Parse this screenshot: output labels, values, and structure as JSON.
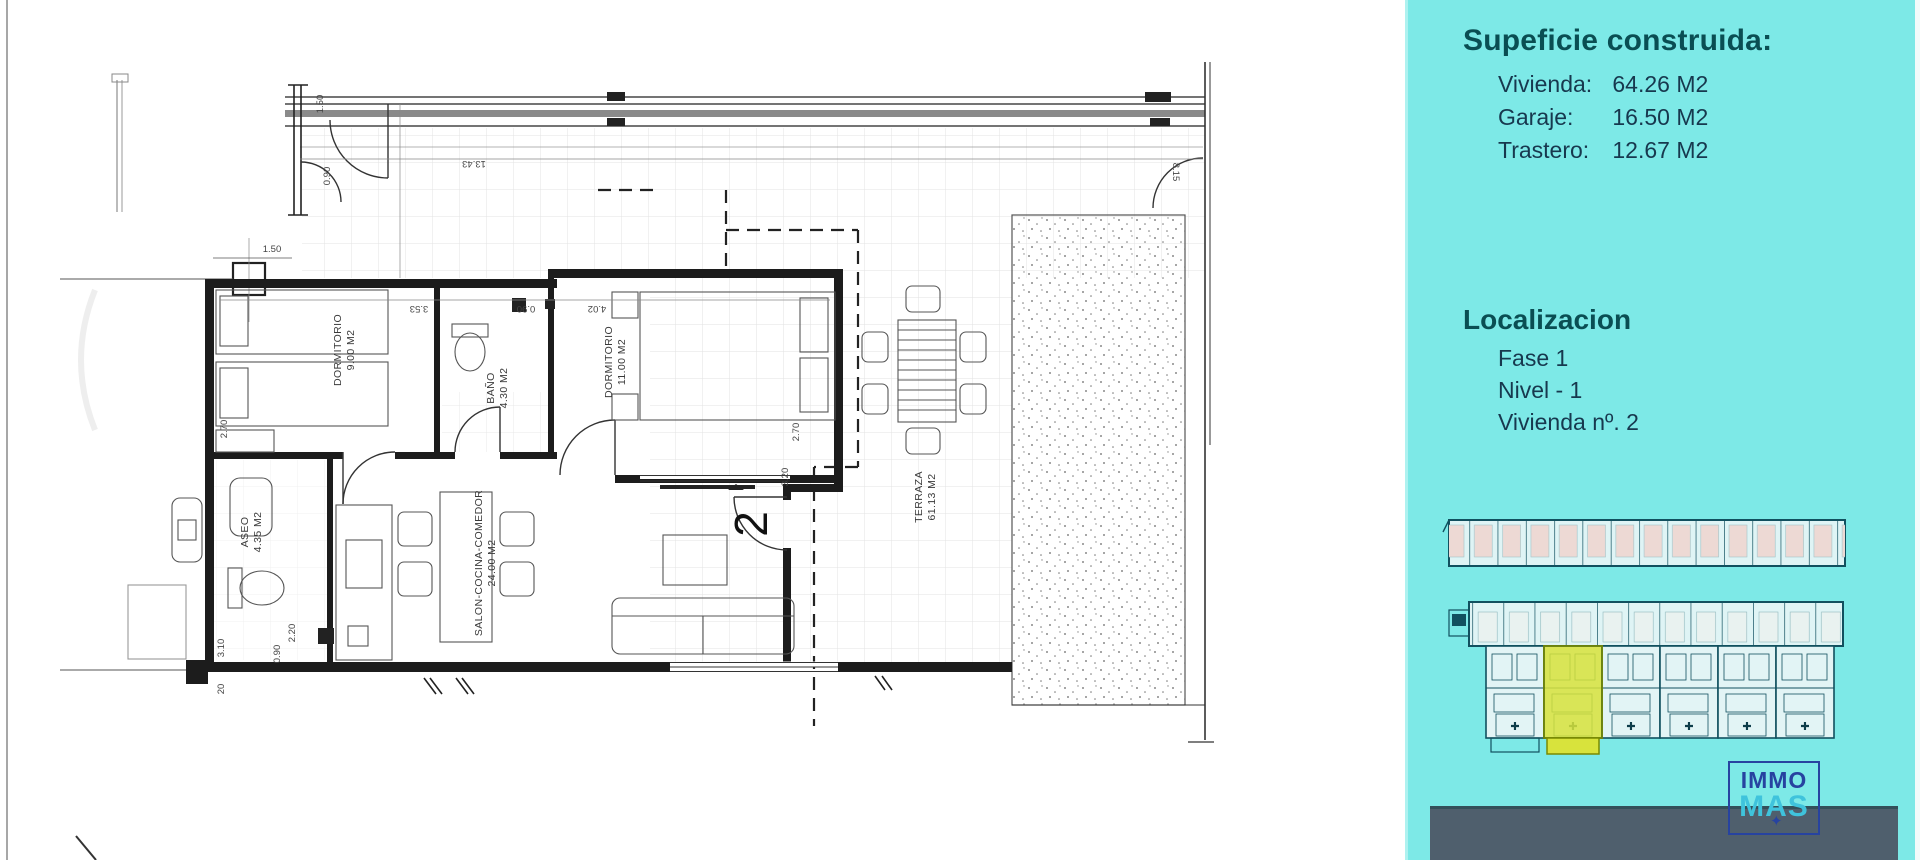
{
  "floorplan": {
    "rooms": [
      {
        "name": "DORMITORIO",
        "area": "9.00 M2"
      },
      {
        "name": "BAÑO",
        "area": "4.30 M2"
      },
      {
        "name": "DORMITORIO",
        "area": "11.00 M2"
      },
      {
        "name": "ASEO",
        "area": "4.35 M2"
      },
      {
        "name": "SALON-COCINA-COMEDOR",
        "area": "24.00 M2"
      },
      {
        "name": "TERRAZA",
        "area": "61.13 M2"
      }
    ],
    "unit_number": "2",
    "dims": [
      "13.43",
      "1.50",
      "0.90",
      "1.50",
      "3.53",
      "0.90",
      "4.02",
      "2.70",
      "2.70",
      "3.20",
      "8.15",
      "2.20",
      "3.10",
      "0.90",
      "20"
    ]
  },
  "sidebar": {
    "background": "#7de9e7",
    "surface": {
      "title": "Supeficie construida:",
      "items": [
        {
          "label": "Vivienda:",
          "value": "64.26 M2"
        },
        {
          "label": "Garaje:",
          "value": "16.50 M2"
        },
        {
          "label": "Trastero:",
          "value": "12.67 M2"
        }
      ]
    },
    "location": {
      "title": "Localizacion",
      "items": [
        "Fase 1",
        "Nivel - 1",
        "Vivienda nº. 2"
      ]
    },
    "minimap": {
      "highlight_color": "#d8e33c",
      "line_color": "#11505f",
      "highlighted_unit": "2"
    },
    "logo": {
      "line1": "IMMO",
      "line2": "MAS",
      "star_icon": "star",
      "navy": "#2743a0",
      "cyan": "#3fc3dc"
    },
    "band_color": "#4f5f6d"
  }
}
